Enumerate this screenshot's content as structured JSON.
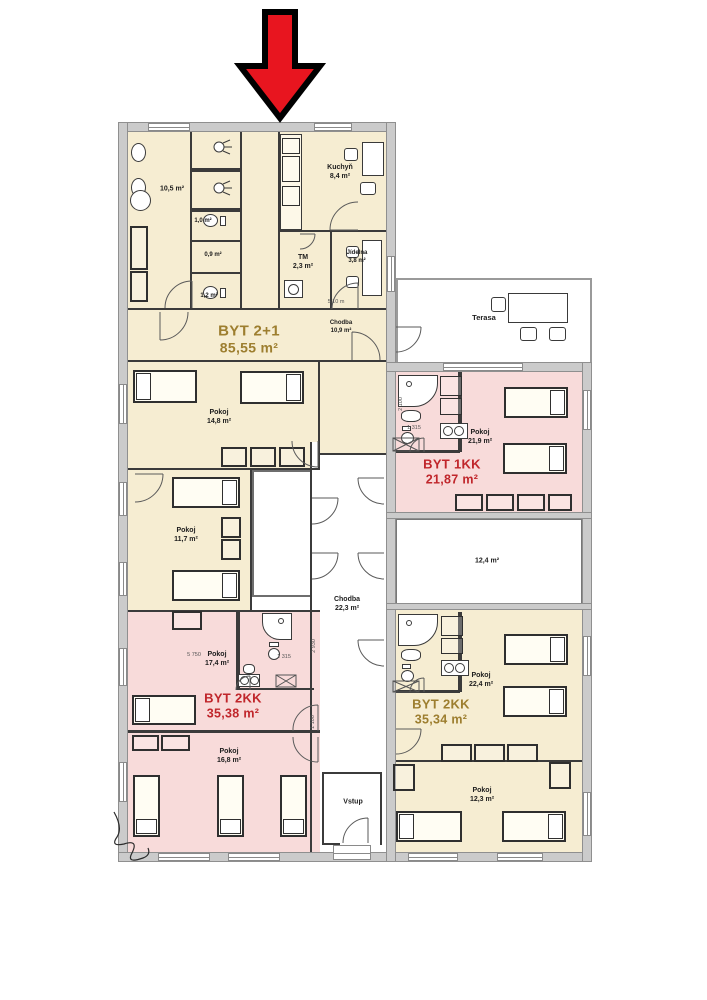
{
  "plan_title": "Floor plan",
  "palette": {
    "cream_room": "#f6edd2",
    "pink_room": "#f8dbda",
    "wall_gray": "#cbcbcb",
    "apartment_gold": "#9d7e2f",
    "apartment_red": "#c0262b",
    "arrow_red": "#e8151f"
  },
  "apartments": {
    "byt21": {
      "name": "BYT 2+1",
      "area": "85,55 m²"
    },
    "byt1kk": {
      "name": "BYT 1KK",
      "area": "21,87 m²"
    },
    "byt2kk_left": {
      "name": "BYT 2KK",
      "area": "35,38 m²"
    },
    "byt2kk_right": {
      "name": "BYT 2KK",
      "area": "35,34 m²"
    }
  },
  "rooms": {
    "bath_105": {
      "area": "10,5 m²"
    },
    "wc_10": {
      "area": "1,0 m²"
    },
    "sat_09": {
      "area": "0,9 m²"
    },
    "wc_12": {
      "area": "1,2 m²"
    },
    "kuchyn": {
      "name": "Kuchyň",
      "area": "8,4 m²"
    },
    "tm": {
      "name": "TM",
      "area": "2,3 m²"
    },
    "jidelna": {
      "name": "Jídelna",
      "area": "3,8 m²"
    },
    "chodba_byt": {
      "name": "Chodba",
      "area": "10,9 m²"
    },
    "pokoj_148": {
      "name": "Pokoj",
      "area": "14,8 m²"
    },
    "pokoj_117": {
      "name": "Pokoj",
      "area": "11,7 m²"
    },
    "pokoj_174": {
      "name": "Pokoj",
      "area": "17,4 m²"
    },
    "pokoj_168": {
      "name": "Pokoj",
      "area": "16,8 m²"
    },
    "pokoj_219": {
      "name": "Pokoj",
      "area": "21,9 m²"
    },
    "room_124": {
      "area": "12,4 m²"
    },
    "pokoj_224": {
      "name": "Pokoj",
      "area": "22,4 m²"
    },
    "pokoj_123": {
      "name": "Pokoj",
      "area": "12,3 m²"
    },
    "chodba_main": {
      "name": "Chodba",
      "area": "22,3 m²"
    },
    "vstup": {
      "name": "Vstup"
    },
    "terasa": {
      "name": "Terasa"
    }
  },
  "dimensions": {
    "d1": "5 750",
    "d2": "1 315",
    "d3": "2 930",
    "d4": "1 100",
    "d5": "1 315",
    "d6": "2 100",
    "d7": "5,10 m"
  }
}
